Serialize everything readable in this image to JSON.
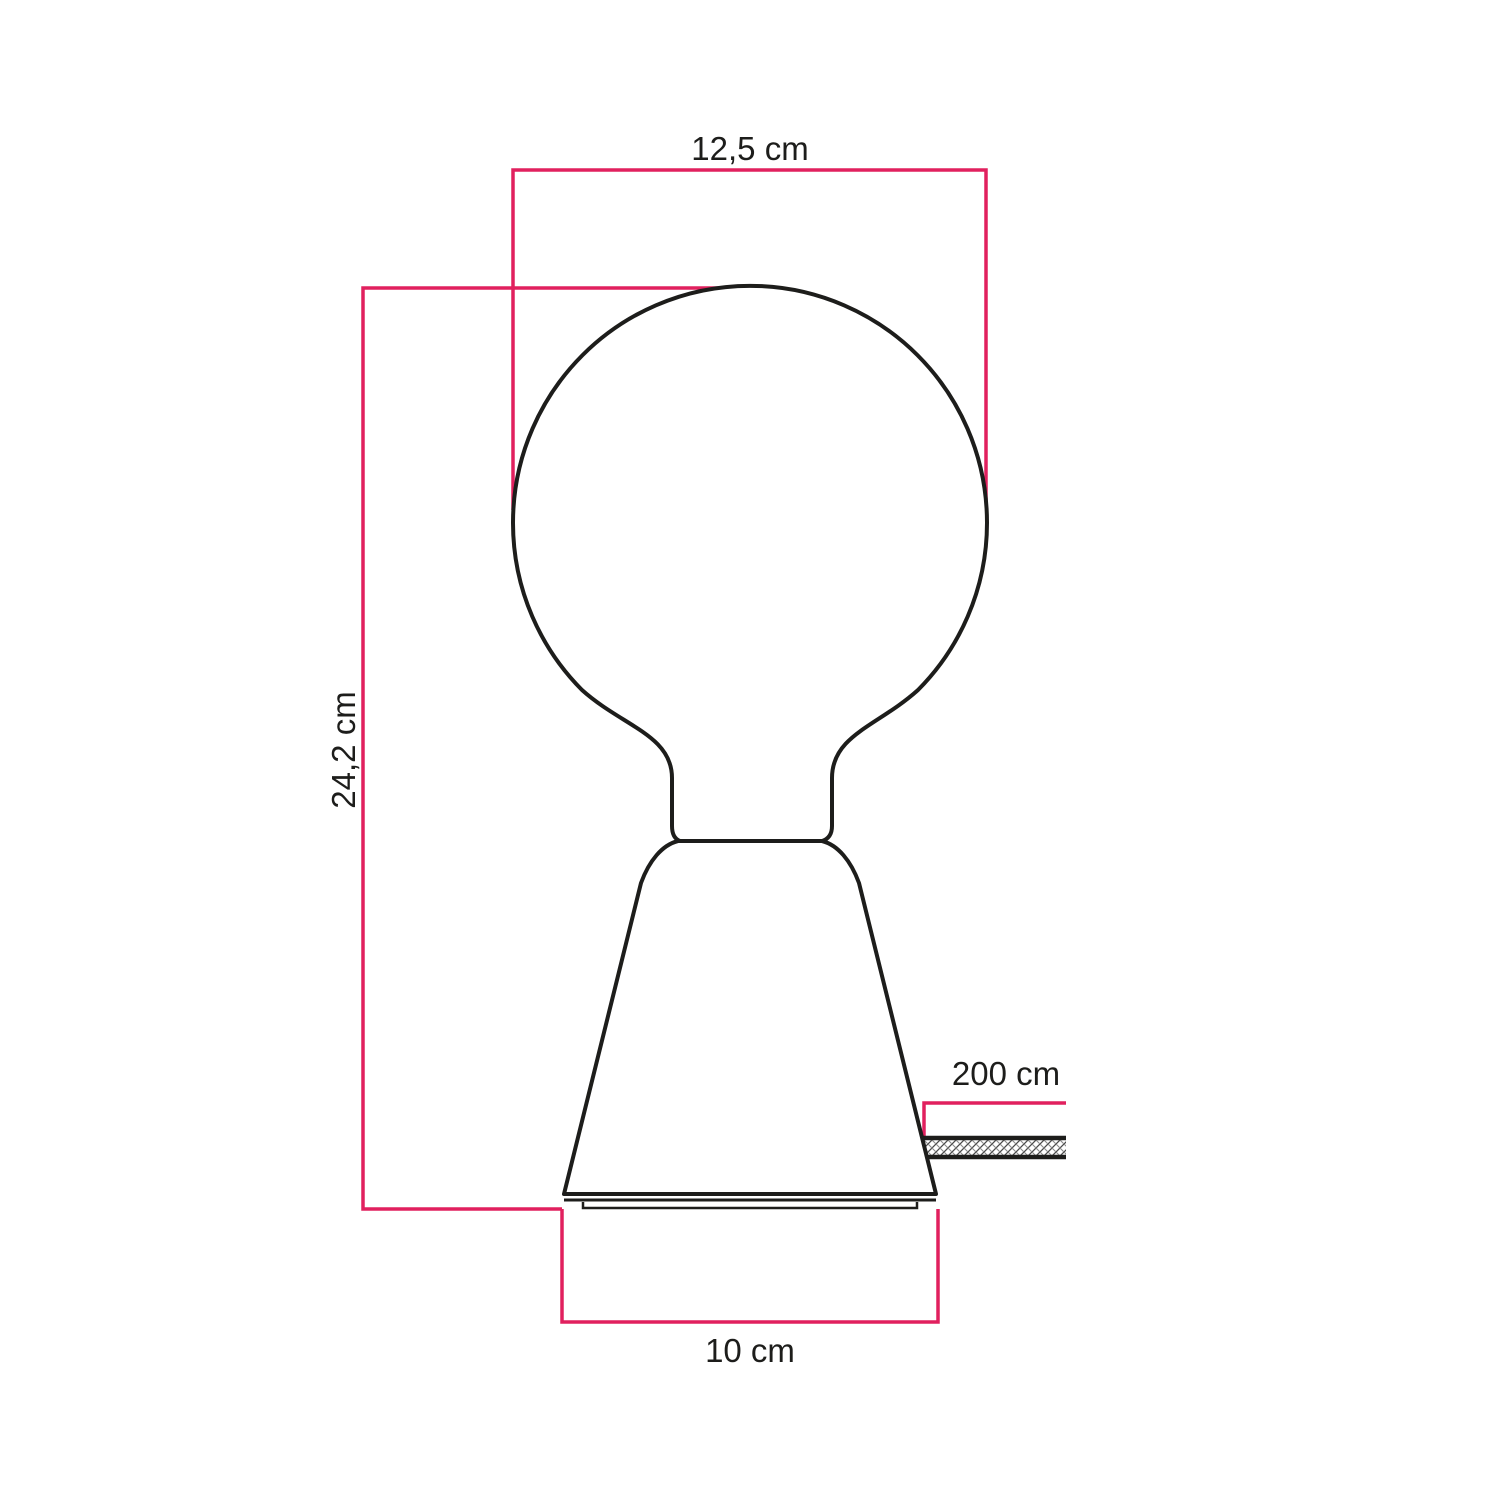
{
  "diagram": {
    "type": "product-dimension-drawing",
    "subject": "table lamp with globe light bulb and fabric cable",
    "dimensions": [
      {
        "id": "bulb-diameter",
        "label": "12,5 cm"
      },
      {
        "id": "total-height",
        "label": "24,2 cm"
      },
      {
        "id": "base-width",
        "label": "10 cm"
      },
      {
        "id": "cable-length",
        "label": "200 cm"
      }
    ],
    "colors": {
      "dimension_line": "#e1205e",
      "outline": "#1d1d1b",
      "background": "#ffffff"
    }
  }
}
